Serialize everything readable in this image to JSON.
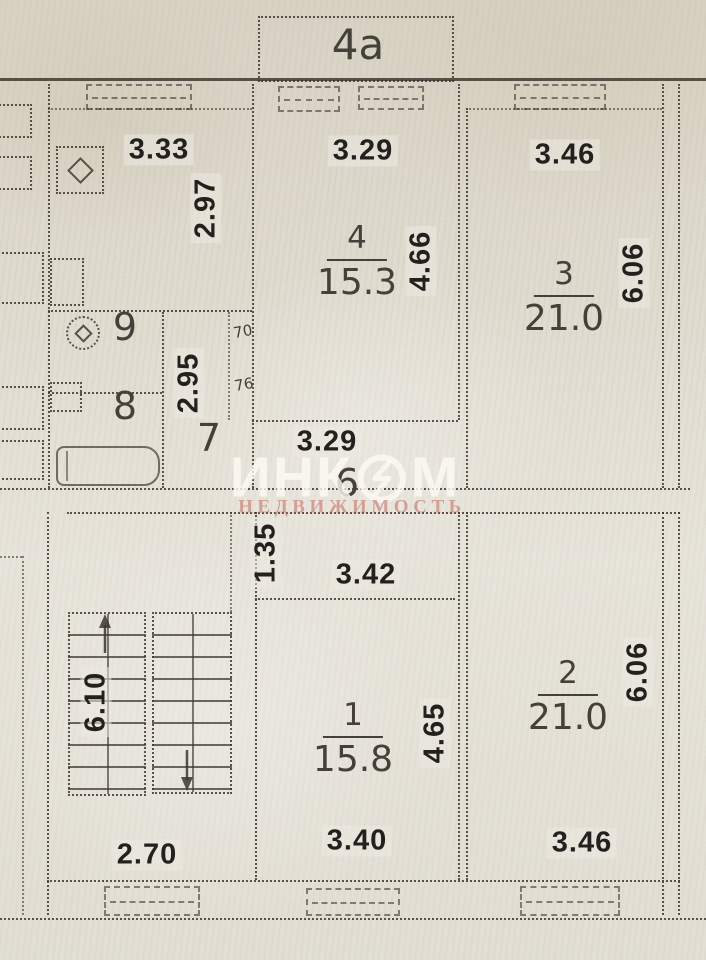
{
  "balcony": {
    "label": "4а"
  },
  "upper": {
    "kitchen": {
      "width": "3.33",
      "height": "2.97"
    },
    "room4": {
      "number": "4",
      "area": "15.3",
      "width": "3.29",
      "height": "4.66"
    },
    "room3": {
      "number": "3",
      "area": "21.0",
      "width": "3.46",
      "height": "6.06"
    },
    "room9": {
      "number": "9"
    },
    "room8": {
      "number": "8"
    },
    "room7": {
      "number": "7"
    },
    "hall6": {
      "number": "6",
      "width": "3.29"
    },
    "wc_height": "2.95",
    "doors": {
      "top": "70",
      "bottom": "76"
    }
  },
  "lower": {
    "corridor": {
      "height": "1.35"
    },
    "room1": {
      "number": "1",
      "area": "15.8",
      "top_width": "3.42",
      "height": "4.65",
      "bottom_width": "3.40"
    },
    "room2": {
      "number": "2",
      "area": "21.0",
      "height": "6.06",
      "bottom_width": "3.46"
    },
    "stairs": {
      "height": "6.10"
    },
    "bottom_left_width": "2.70"
  },
  "watermark": {
    "brand_left": "ИНК",
    "brand_right": "М",
    "subtitle": "НЕДВИЖИМОСТЬ"
  },
  "colors": {
    "paper": "#e0dcd0",
    "ink": "#23211d",
    "wall_line": "#3e3a30",
    "watermark_white": "rgba(252,250,244,0.80)",
    "watermark_red": "rgba(196,114,104,0.60)"
  }
}
